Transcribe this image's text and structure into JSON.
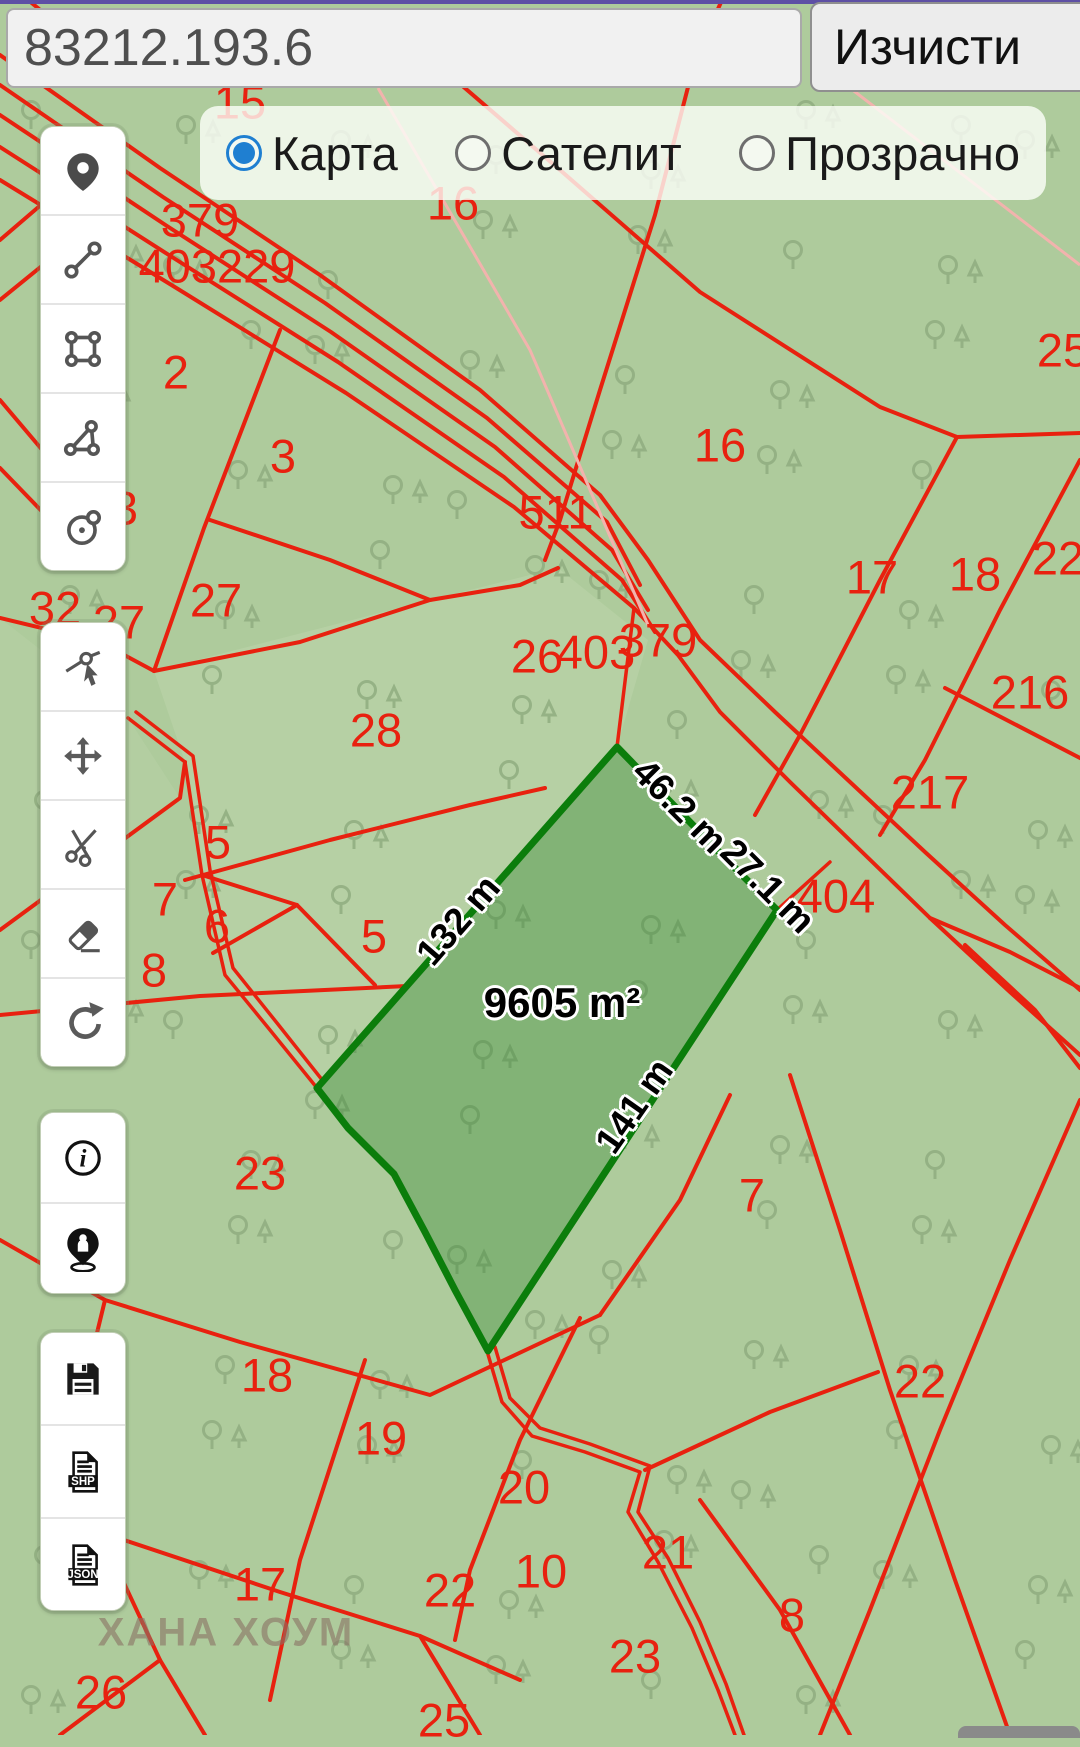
{
  "topbar": {
    "input_value": "83212.193.6",
    "clear_label": "Изчисти"
  },
  "layer_control": {
    "options": [
      {
        "label": "Карта",
        "selected": true
      },
      {
        "label": "Сателит",
        "selected": false
      },
      {
        "label": "Прозрачно",
        "selected": false
      }
    ]
  },
  "toolbar": {
    "groups": [
      {
        "top": 126,
        "btn_h": 87,
        "buttons": [
          {
            "icon": "map-pin-icon"
          },
          {
            "icon": "measure-line-icon"
          },
          {
            "icon": "draw-rectangle-icon"
          },
          {
            "icon": "draw-polygon-icon"
          },
          {
            "icon": "draw-circle-icon"
          }
        ]
      },
      {
        "top": 622,
        "btn_h": 87,
        "buttons": [
          {
            "icon": "select-vertex-icon"
          },
          {
            "icon": "move-icon"
          },
          {
            "icon": "cut-icon"
          },
          {
            "icon": "eraser-icon"
          },
          {
            "icon": "undo-icon"
          }
        ]
      },
      {
        "top": 1112,
        "btn_h": 89,
        "buttons": [
          {
            "icon": "info-icon"
          },
          {
            "icon": "person-location-icon"
          }
        ]
      },
      {
        "top": 1332,
        "btn_h": 91,
        "buttons": [
          {
            "icon": "save-icon"
          },
          {
            "icon": "file-export-icon",
            "badge": "SHP"
          },
          {
            "icon": "file-export-icon",
            "badge": "JSON"
          }
        ]
      }
    ]
  },
  "selected_parcel": {
    "area_label": "9605 m²",
    "area_x": 562,
    "area_y": 1003,
    "edge_labels": [
      {
        "text": "132 m",
        "x": 458,
        "y": 920,
        "rot": -49
      },
      {
        "text": "46.2 m",
        "x": 680,
        "y": 806,
        "rot": 45
      },
      {
        "text": "27.1 m",
        "x": 768,
        "y": 886,
        "rot": 45
      },
      {
        "text": "141 m",
        "x": 634,
        "y": 1106,
        "rot": -55
      }
    ]
  },
  "map": {
    "watermark": {
      "text": "ХАНА ХОУМ",
      "x": 226,
      "y": 1633
    },
    "parcel_numbers": [
      {
        "text": "15",
        "x": 240,
        "y": 102
      },
      {
        "text": "379",
        "x": 200,
        "y": 220
      },
      {
        "text": "403229",
        "x": 217,
        "y": 266
      },
      {
        "text": "16",
        "x": 453,
        "y": 203
      },
      {
        "text": "2",
        "x": 176,
        "y": 372
      },
      {
        "text": "3",
        "x": 283,
        "y": 456
      },
      {
        "text": "3",
        "x": 125,
        "y": 508
      },
      {
        "text": "25",
        "x": 1063,
        "y": 350
      },
      {
        "text": "16",
        "x": 720,
        "y": 445
      },
      {
        "text": "511",
        "x": 556,
        "y": 512
      },
      {
        "text": "17",
        "x": 872,
        "y": 577
      },
      {
        "text": "18",
        "x": 975,
        "y": 574
      },
      {
        "text": "22",
        "x": 1058,
        "y": 558
      },
      {
        "text": "32",
        "x": 55,
        "y": 608
      },
      {
        "text": "27",
        "x": 119,
        "y": 622
      },
      {
        "text": "27",
        "x": 216,
        "y": 600
      },
      {
        "text": "216",
        "x": 1030,
        "y": 692
      },
      {
        "text": "26",
        "x": 537,
        "y": 656
      },
      {
        "text": "403",
        "x": 596,
        "y": 652
      },
      {
        "text": "379",
        "x": 658,
        "y": 640
      },
      {
        "text": "217",
        "x": 930,
        "y": 792
      },
      {
        "text": "28",
        "x": 376,
        "y": 730
      },
      {
        "text": "404",
        "x": 836,
        "y": 896
      },
      {
        "text": "5",
        "x": 218,
        "y": 842
      },
      {
        "text": "7",
        "x": 165,
        "y": 899
      },
      {
        "text": "6",
        "x": 217,
        "y": 926
      },
      {
        "text": "8",
        "x": 154,
        "y": 970
      },
      {
        "text": "5",
        "x": 374,
        "y": 936
      },
      {
        "text": "23",
        "x": 260,
        "y": 1173
      },
      {
        "text": "7",
        "x": 752,
        "y": 1195
      },
      {
        "text": "18",
        "x": 267,
        "y": 1375
      },
      {
        "text": "19",
        "x": 381,
        "y": 1438
      },
      {
        "text": "20",
        "x": 524,
        "y": 1487
      },
      {
        "text": "22",
        "x": 920,
        "y": 1381
      },
      {
        "text": "21",
        "x": 668,
        "y": 1552
      },
      {
        "text": "10",
        "x": 541,
        "y": 1571
      },
      {
        "text": "17",
        "x": 260,
        "y": 1584
      },
      {
        "text": "22",
        "x": 450,
        "y": 1590
      },
      {
        "text": "8",
        "x": 792,
        "y": 1615
      },
      {
        "text": "23",
        "x": 635,
        "y": 1656
      },
      {
        "text": "26",
        "x": 101,
        "y": 1692
      },
      {
        "text": "25",
        "x": 444,
        "y": 1720
      }
    ]
  },
  "colors": {
    "map_background": "#aecb9c",
    "boundary_red": "#e8210f",
    "parcel_fill": "rgba(30,125,30,0.30)",
    "parcel_stroke": "#0b7d0b",
    "tree_green": "#90ad80",
    "accent_purple": "#5e50a5",
    "radio_blue": "#1f7fd1"
  }
}
